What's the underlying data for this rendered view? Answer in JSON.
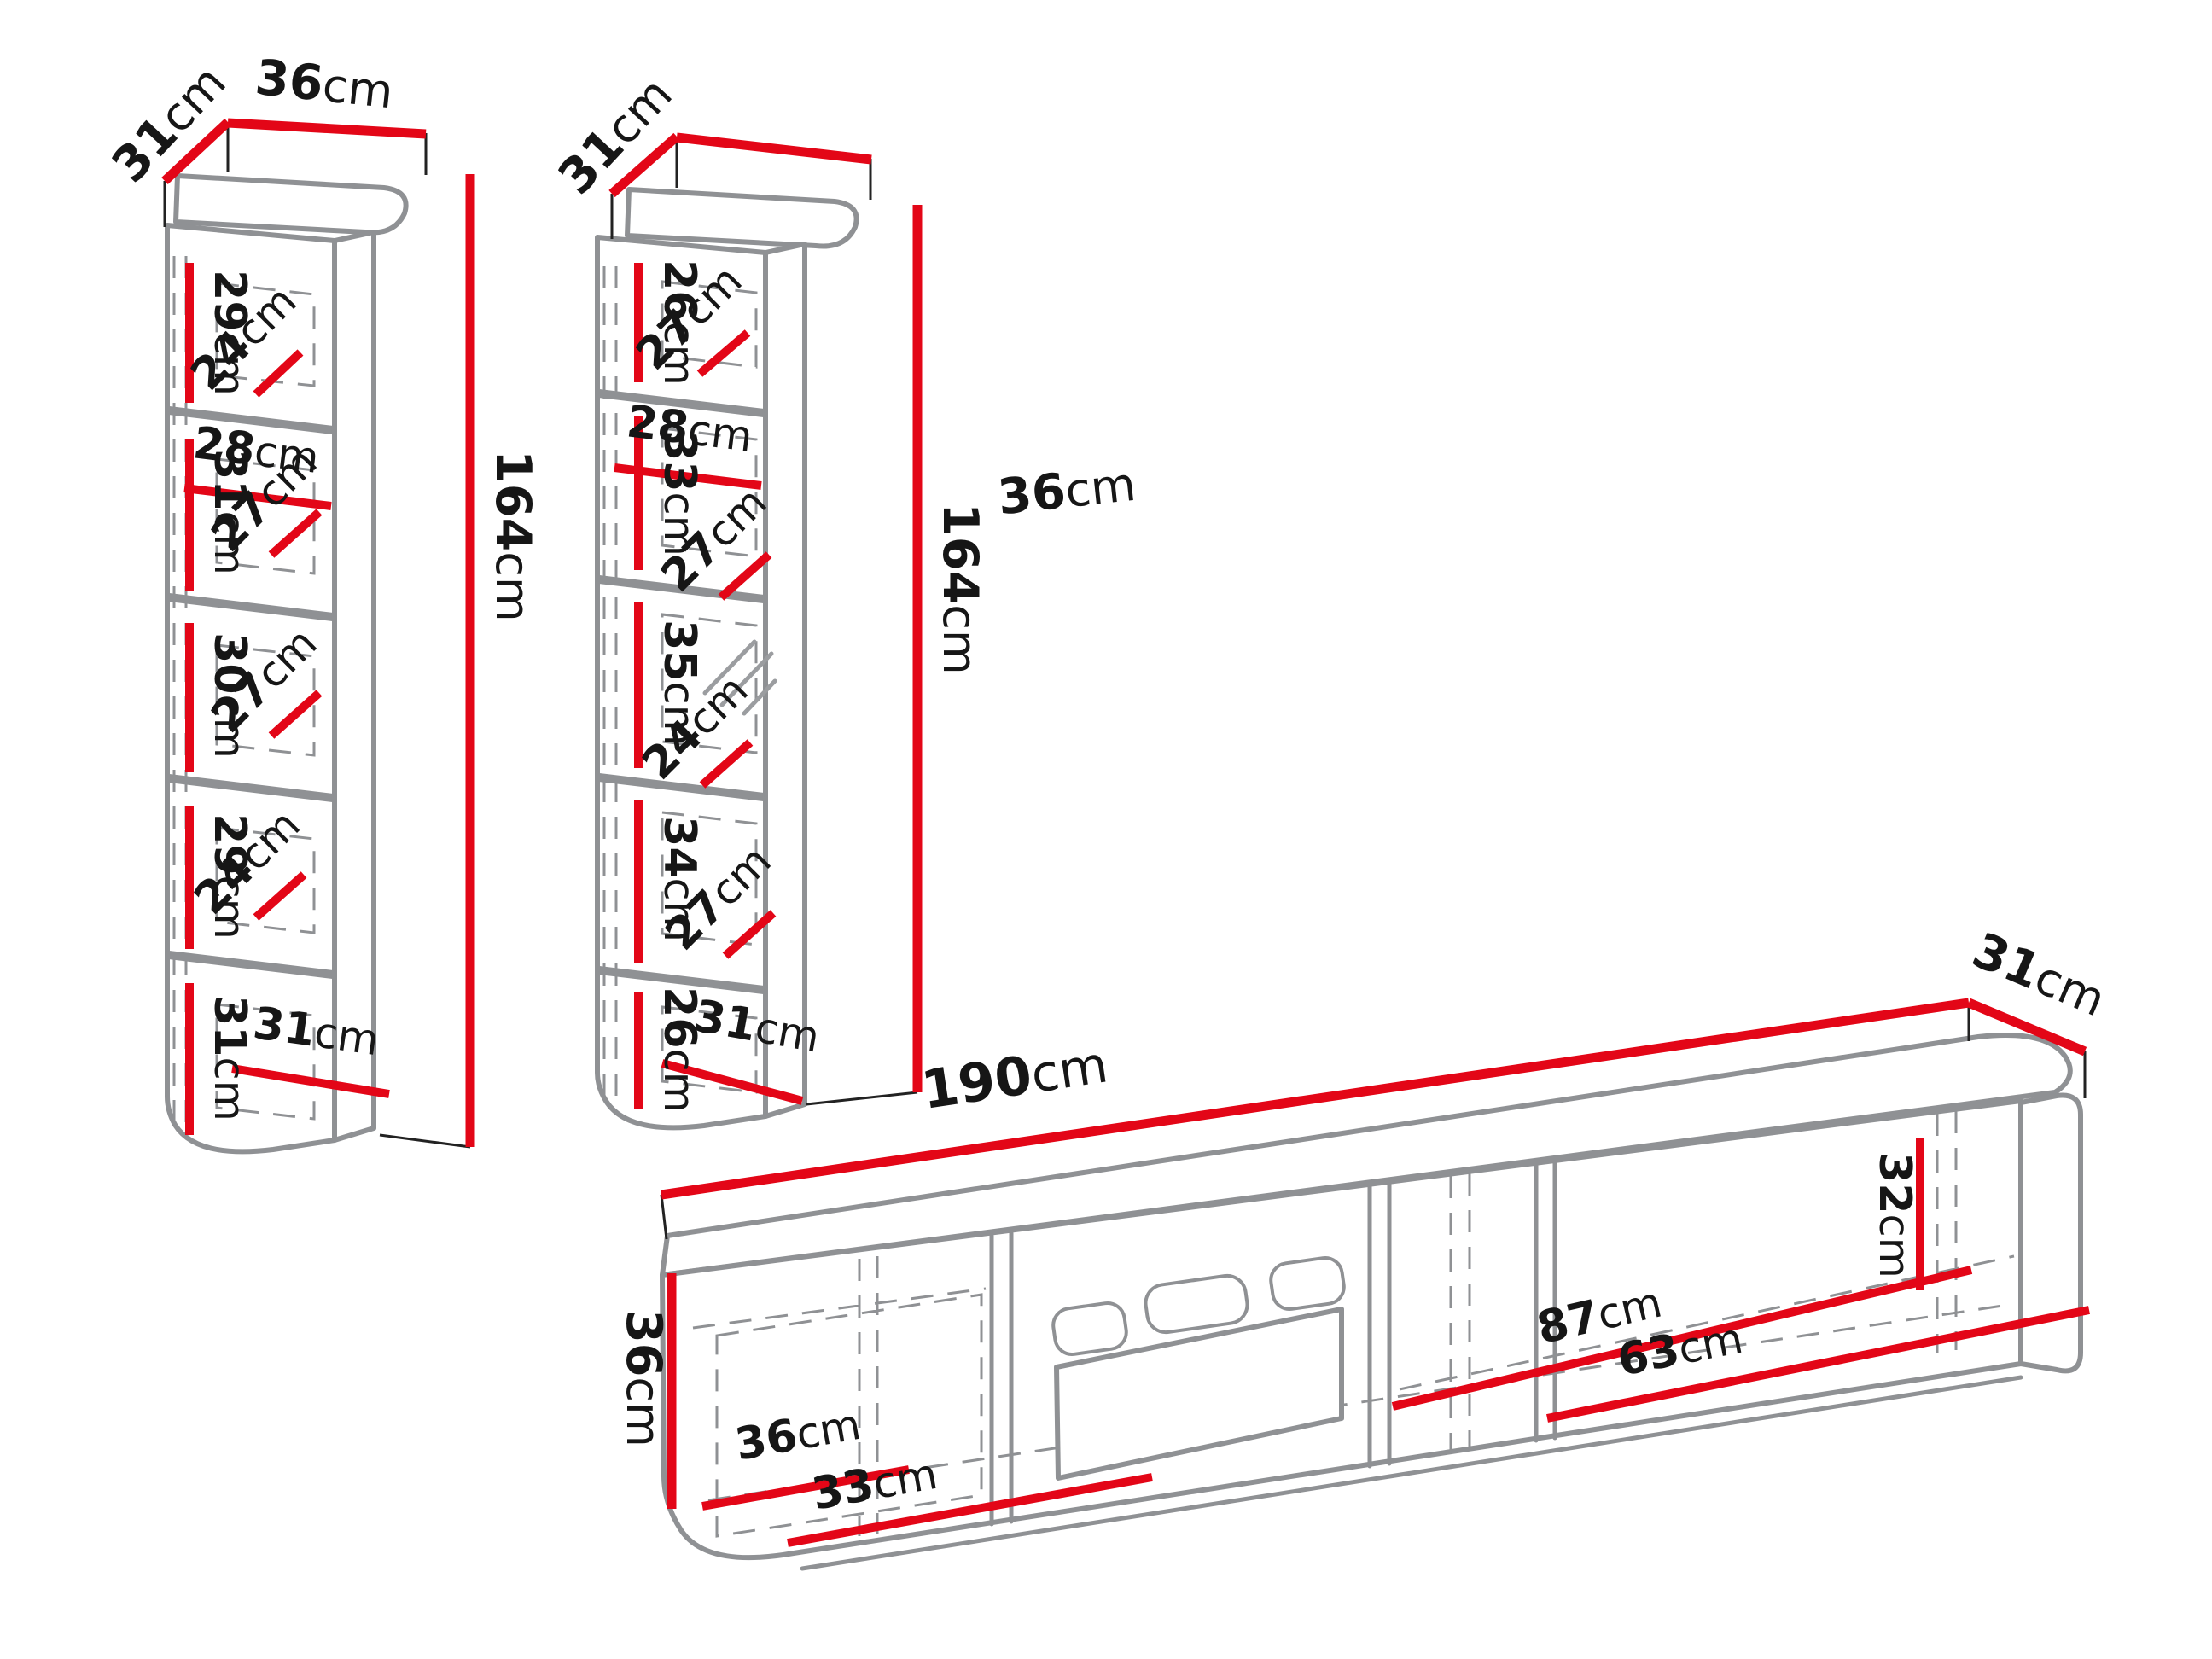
{
  "diagram": {
    "title": "wall unit furniture dimensions",
    "unit": "cm",
    "colors": {
      "dimension_line": "#e30617",
      "outline": "#8f9194",
      "text": "#161616"
    },
    "left_cabinet": {
      "depth": {
        "value": "31",
        "unit": "cm"
      },
      "width": {
        "value": "36",
        "unit": "cm"
      },
      "height": {
        "value": "164",
        "unit": "cm"
      },
      "shelf_width": {
        "value": "28",
        "unit": "cm"
      },
      "bottom_width": {
        "value": "31",
        "unit": "cm"
      },
      "sections": [
        {
          "height": {
            "value": "29",
            "unit": "cm"
          },
          "depth": {
            "value": "24",
            "unit": "cm"
          }
        },
        {
          "height": {
            "value": "31",
            "unit": "cm"
          },
          "depth": {
            "value": "27",
            "unit": "cm"
          }
        },
        {
          "height": {
            "value": "30",
            "unit": "cm"
          },
          "depth": {
            "value": "27",
            "unit": "cm"
          }
        },
        {
          "height": {
            "value": "29",
            "unit": "cm"
          },
          "depth": {
            "value": "24",
            "unit": "cm"
          }
        },
        {
          "height": {
            "value": "31",
            "unit": "cm"
          }
        }
      ]
    },
    "middle_cabinet": {
      "depth": {
        "value": "31",
        "unit": "cm"
      },
      "width": {
        "value": "36",
        "unit": "cm"
      },
      "height": {
        "value": "164",
        "unit": "cm"
      },
      "shelf_width": {
        "value": "28",
        "unit": "cm"
      },
      "bottom_width": {
        "value": "31",
        "unit": "cm"
      },
      "sections": [
        {
          "height": {
            "value": "26",
            "unit": "cm"
          },
          "depth": {
            "value": "27",
            "unit": "cm"
          }
        },
        {
          "height": {
            "value": "33",
            "unit": "cm"
          },
          "depth": {
            "value": "27",
            "unit": "cm"
          }
        },
        {
          "height": {
            "value": "35",
            "unit": "cm"
          },
          "depth": {
            "value": "24",
            "unit": "cm"
          }
        },
        {
          "height": {
            "value": "34",
            "unit": "cm"
          },
          "depth": {
            "value": "27",
            "unit": "cm"
          }
        },
        {
          "height": {
            "value": "26",
            "unit": "cm"
          }
        }
      ]
    },
    "tv_stand": {
      "width": {
        "value": "190",
        "unit": "cm"
      },
      "depth": {
        "value": "31",
        "unit": "cm"
      },
      "height": {
        "value": "36",
        "unit": "cm"
      },
      "inner_depth": {
        "value": "36",
        "unit": "cm"
      },
      "left_section_width": {
        "value": "33",
        "unit": "cm"
      },
      "span_width": {
        "value": "87",
        "unit": "cm"
      },
      "right_section_width": {
        "value": "63",
        "unit": "cm"
      },
      "inner_height": {
        "value": "32",
        "unit": "cm"
      }
    }
  }
}
